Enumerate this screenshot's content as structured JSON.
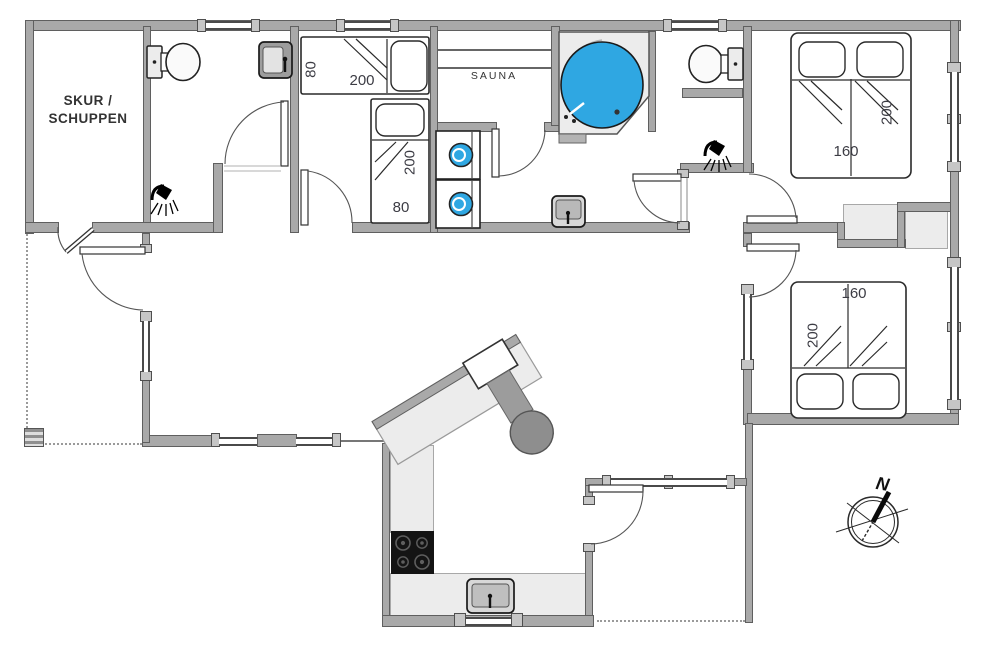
{
  "colors": {
    "wall": "#a9a9a9",
    "water": "#2fa7e2",
    "counter": "#ececec",
    "stove": "#141414"
  },
  "rooms": {
    "shed": {
      "line1": "SKUR /",
      "line2": "SCHUPPEN"
    },
    "sauna": {
      "label": "SAUNA"
    }
  },
  "beds": {
    "single_top": {
      "width": "80",
      "length": "200"
    },
    "single_bottom": {
      "width": "80",
      "length": "200"
    },
    "double_upper": {
      "width": "160",
      "length": "200"
    },
    "double_lower": {
      "width": "160",
      "length": "200"
    }
  },
  "compass": {
    "north": "N"
  },
  "icons": [
    "toilet-icon",
    "sink-icon",
    "shower-icon",
    "washing-machine-icon",
    "corner-bathtub-icon",
    "sauna-bench-icon",
    "stove-icon",
    "fireplace-icon",
    "kitchen-sink-icon",
    "compass-rose-icon",
    "wardrobe-icon"
  ]
}
